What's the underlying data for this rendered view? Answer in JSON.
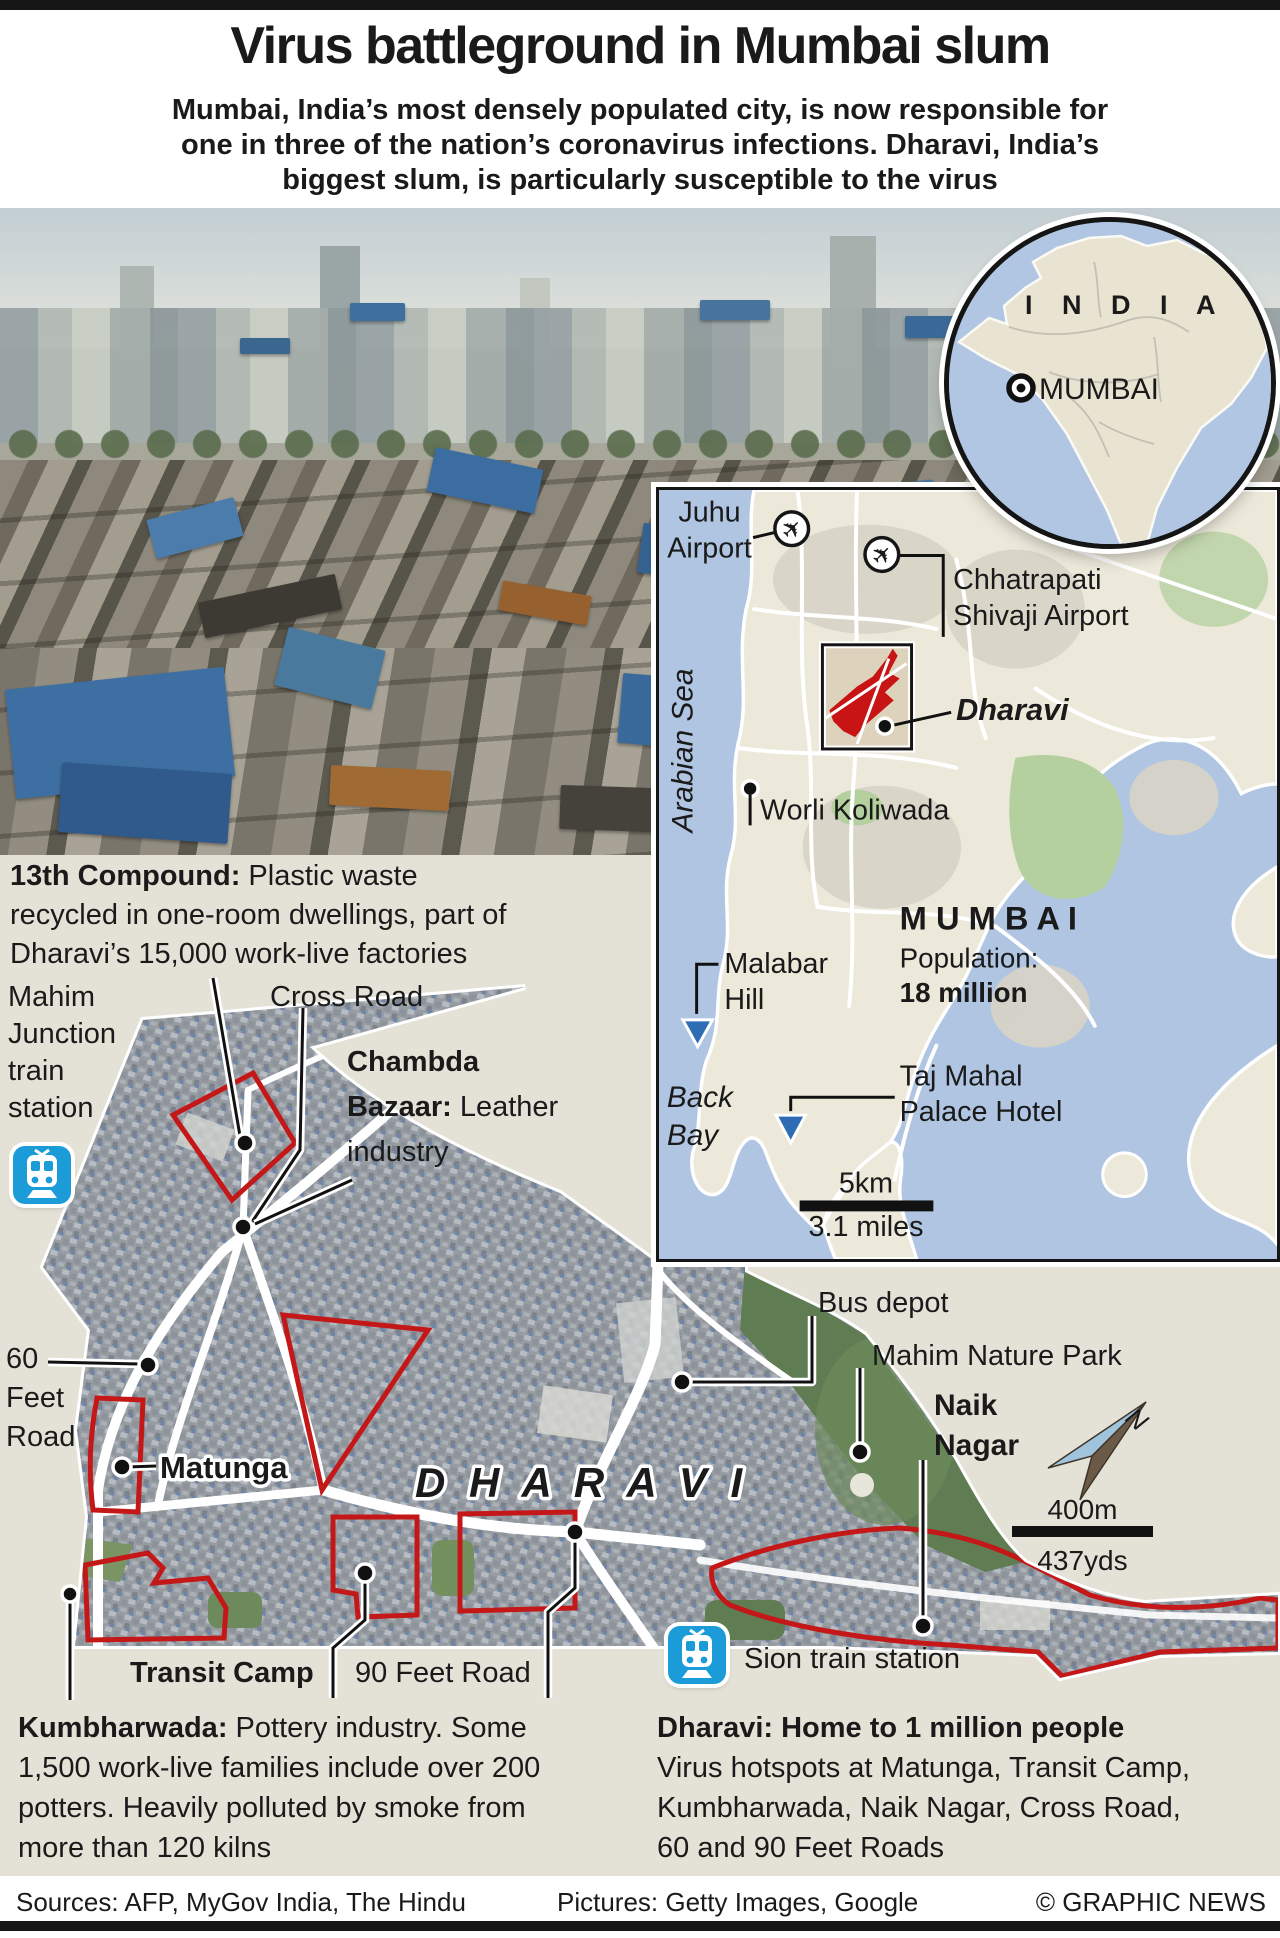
{
  "header": {
    "title": "Virus battleground in Mumbai slum",
    "subtitle_lines": [
      "Mumbai, India’s most densely populated city, is now responsible for",
      "one in three of the nation’s coronavirus infections. Dharavi, India’s",
      "biggest slum, is particularly susceptible to the virus"
    ]
  },
  "india_inset": {
    "country": "I N D I A",
    "city": "MUMBAI"
  },
  "mumbai_map": {
    "juhu1": "Juhu",
    "juhu2": "Airport",
    "csa1": "Chhatrapati",
    "csa2": "Shivaji Airport",
    "arabian_sea": "Arabian Sea",
    "dharavi": "Dharavi",
    "worli": "Worli Koliwada",
    "malabar1": "Malabar",
    "malabar2": "Hill",
    "city": "M U M B A I",
    "population_label": "Population:",
    "population_value": "18 million",
    "back1": "Back",
    "back2": "Bay",
    "taj1": "Taj Mahal",
    "taj2": "Palace Hotel",
    "scale_top": "5km",
    "scale_bottom": "3.1 miles"
  },
  "sat_map": {
    "compound13_bold": "13th Compound:",
    "compound13_rest": " Plastic waste recycled in one-room dwellings, part of Dharavi’s 15,000 work-live factories",
    "mahim_junction_lines": [
      "Mahim",
      "Junction",
      "train",
      "station"
    ],
    "cross_road": "Cross Road",
    "chambda_l1": "Chambda",
    "chambda_l2_bold": "Bazaar:",
    "chambda_l2_rest": " Leather",
    "chambda_l3": "industry",
    "feet60_lines": [
      "60",
      "Feet",
      "Road"
    ],
    "matunga": "Matunga",
    "dharavi_big": "D H A R A V I",
    "bus_depot": "Bus depot",
    "mahim_park": "Mahim Nature Park",
    "naik_lines": [
      "Naik",
      "Nagar"
    ],
    "compass_n": "N",
    "scale_top": "400m",
    "scale_bottom": "437yds",
    "transit_camp": "Transit Camp",
    "feet90": "90 Feet Road",
    "sion": "Sion train station"
  },
  "footnotes": {
    "kumbharwada_bold": "Kumbharwada:",
    "kumbharwada_rest": " Pottery industry. Some 1,500 work-live families include over 200 potters. Heavily polluted by smoke from more than 120 kilns",
    "dharavi_bold": "Dharavi: Home to 1 million people",
    "dharavi_rest": "Virus hotspots at Matunga, Transit Camp, Kumbharwada, Naik Nagar, Cross Road, 60 and 90 Feet Roads"
  },
  "footer": {
    "sources": "Sources: AFP, MyGov India, The Hindu",
    "pictures": "Pictures: Getty Images, Google",
    "credit": "© GRAPHIC NEWS"
  },
  "colors": {
    "accent_red": "#c41717",
    "sea_blue": "#afc5e2",
    "land_beige": "#ece8da",
    "park_green": "#b4d09e",
    "background_beige": "#e4e1d7",
    "train_blue": "#1b9cd8",
    "water_label_blue": "#3a72ad"
  }
}
